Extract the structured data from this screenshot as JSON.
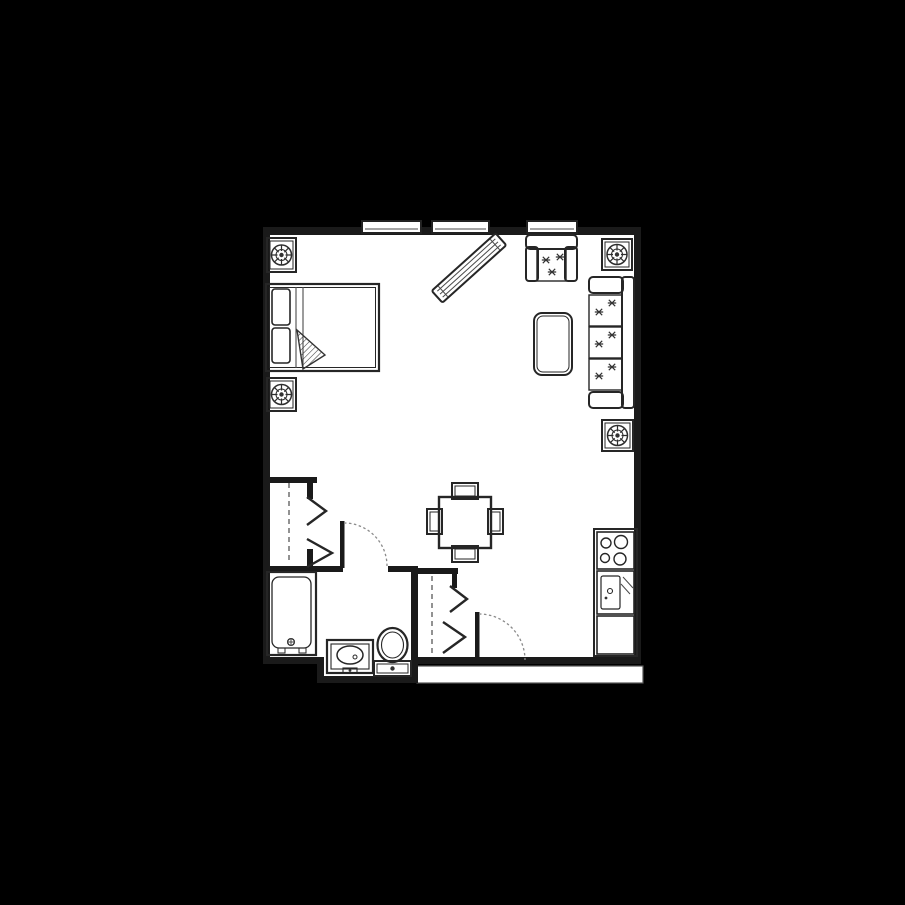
{
  "scene": {
    "background_color": "#000000",
    "wall_color": "#1a1a1a",
    "floor_color": "#ffffff",
    "furniture_line_color": "#262626",
    "dashed_line_color": "#6e6e6e"
  },
  "plan": {
    "title": "Studio apartment floor plan",
    "rooms": [
      {
        "id": "living-bedroom",
        "label": "Living and sleeping area"
      },
      {
        "id": "bathroom",
        "label": "Bathroom"
      },
      {
        "id": "entry",
        "label": "Entry"
      },
      {
        "id": "kitchenette",
        "label": "Kitchenette"
      },
      {
        "id": "closet-bedroom",
        "label": "Closet with bifold doors"
      },
      {
        "id": "closet-entry",
        "label": "Entry closet with bifold doors"
      }
    ],
    "windows_count": 3,
    "window_label": "Window",
    "doors": [
      {
        "id": "bathroom-door",
        "label": "Bathroom swing door"
      },
      {
        "id": "entry-door",
        "label": "Entry swing door"
      }
    ],
    "furniture": [
      {
        "id": "double-bed",
        "label": "Double bed"
      },
      {
        "id": "plant-top-left",
        "label": "Potted plant"
      },
      {
        "id": "plant-left",
        "label": "Potted plant"
      },
      {
        "id": "plant-top-right",
        "label": "Potted plant"
      },
      {
        "id": "plant-right",
        "label": "Potted plant"
      },
      {
        "id": "armchair",
        "label": "Armchair"
      },
      {
        "id": "coffee-table",
        "label": "Coffee table"
      },
      {
        "id": "sofa",
        "label": "Three-seat sofa"
      },
      {
        "id": "diagonal-console",
        "label": "Console cabinet (diagonal)"
      },
      {
        "id": "dining-table",
        "label": "Dining table"
      },
      {
        "id": "dining-chair",
        "label": "Dining chair"
      },
      {
        "id": "bathtub",
        "label": "Bathtub"
      },
      {
        "id": "vanity-sink",
        "label": "Vanity sink"
      },
      {
        "id": "toilet",
        "label": "Toilet"
      },
      {
        "id": "stove",
        "label": "Four-burner stove"
      },
      {
        "id": "kitchen-sink",
        "label": "Kitchen sink"
      },
      {
        "id": "kitchen-counter",
        "label": "Counter cabinet"
      },
      {
        "id": "entry-landing",
        "label": "Entry landing"
      }
    ]
  }
}
